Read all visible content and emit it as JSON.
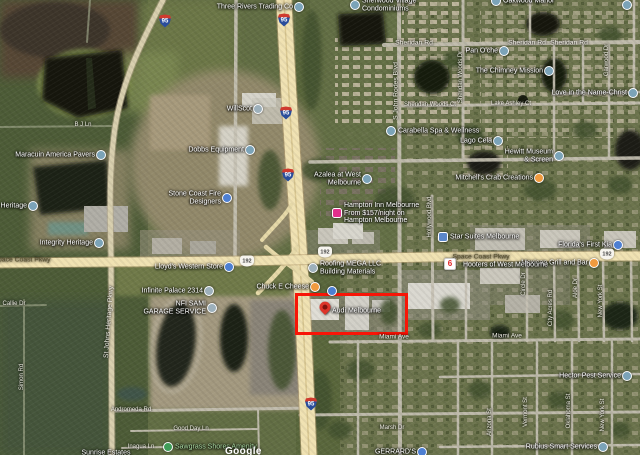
{
  "map": {
    "attribution": "Google",
    "colors": {
      "highlight_red": "#f81507",
      "major_road": "#f0e2b2",
      "water": "#161a0e",
      "marker_default": "#7ba3b8",
      "marker_store_blue": "#4d7fd2",
      "marker_restaurant_orange": "#f09a3e",
      "marker_hotel_pink": "#e2308c",
      "marker_park_green": "#3f9d58"
    },
    "highlight": {
      "label": "Audi Melbourne",
      "x": 295,
      "y": 293,
      "w": 107,
      "h": 36
    },
    "pois": [
      {
        "id": "three-rivers-trading-co",
        "lines": [
          "Three Rivers Trading Co"
        ],
        "x": 299,
        "y": 7,
        "side": "left",
        "shape": "circle",
        "color": "#7ba3b8"
      },
      {
        "id": "sherwood-village-condominiums",
        "lines": [
          "Sherwood Village",
          "Condominiums"
        ],
        "x": 355,
        "y": 5,
        "side": "right",
        "shape": "circle",
        "color": "#7ba3b8"
      },
      {
        "id": "oakwood-manor",
        "lines": [
          "Oakwood Manor"
        ],
        "x": 496,
        "y": 1,
        "side": "right",
        "shape": "circle",
        "color": "#7ba3b8"
      },
      {
        "id": "pan-oche",
        "lines": [
          "Pan O'che"
        ],
        "x": 504,
        "y": 51,
        "side": "left",
        "shape": "circle",
        "color": "#7ba3b8"
      },
      {
        "id": "the-chimney-mission",
        "lines": [
          "The Chimney Mission"
        ],
        "x": 549,
        "y": 71,
        "side": "left",
        "shape": "circle",
        "color": "#7ba3b8"
      },
      {
        "id": "love-in-the-name-christ",
        "lines": [
          "Love in the Name-Christ"
        ],
        "x": 633,
        "y": 93,
        "side": "left",
        "shape": "circle",
        "color": "#7ba3b8"
      },
      {
        "id": "carabella-spa-wellness",
        "lines": [
          "Carabella Spa & Wellness"
        ],
        "x": 391,
        "y": 131,
        "side": "right",
        "shape": "circle",
        "color": "#7ba3b8"
      },
      {
        "id": "willscot",
        "lines": [
          "WillScot"
        ],
        "x": 258,
        "y": 109,
        "side": "left",
        "shape": "circle",
        "color": "#9db0bb"
      },
      {
        "id": "dobbs-equipment",
        "lines": [
          "Dobbs Equipment"
        ],
        "x": 250,
        "y": 150,
        "side": "left",
        "shape": "circle",
        "color": "#7ba3b8"
      },
      {
        "id": "stone-coast-fire-designers",
        "lines": [
          "Stone Coast Fire",
          "Designers"
        ],
        "x": 227,
        "y": 198,
        "side": "left",
        "shape": "circle",
        "color": "#4d7fd2"
      },
      {
        "id": "maracuin-america-pavers",
        "lines": [
          "Maracuin America Pavers"
        ],
        "x": 101,
        "y": 155,
        "side": "left",
        "shape": "circle",
        "color": "#7ba3b8"
      },
      {
        "id": "a-heritage",
        "lines": [
          "…a Heritage"
        ],
        "x": 33,
        "y": 206,
        "side": "left",
        "shape": "circle",
        "color": "#7ba3b8"
      },
      {
        "id": "integrity-heritage",
        "lines": [
          "Integrity Heritage"
        ],
        "x": 99,
        "y": 243,
        "side": "left",
        "shape": "circle",
        "color": "#7ba3b8"
      },
      {
        "id": "infinite-palace-2314",
        "lines": [
          "Infinite Palace 2314"
        ],
        "x": 209,
        "y": 291,
        "side": "left",
        "shape": "circle",
        "color": "#9db0bb"
      },
      {
        "id": "nfi-sami-garage-service",
        "lines": [
          "NFI SAMI",
          "GARAGE SERVICE"
        ],
        "x": 212,
        "y": 308,
        "side": "left",
        "shape": "circle",
        "color": "#9db0bb"
      },
      {
        "id": "lloyds-western-store",
        "lines": [
          "Lloyd's Western Store"
        ],
        "x": 229,
        "y": 267,
        "side": "left",
        "shape": "circle",
        "color": "#4d7fd2"
      },
      {
        "id": "roofing-mega-llc",
        "lines": [
          "Roofing MEGA LLC",
          "Building Materials"
        ],
        "x": 313,
        "y": 268,
        "side": "right",
        "shape": "circle",
        "color": "#9db0bb"
      },
      {
        "id": "chuck-e-cheese",
        "lines": [
          "Chuck E Cheese"
        ],
        "x": 315,
        "y": 287,
        "side": "left",
        "shape": "circle",
        "color": "#f09a3e"
      },
      {
        "id": "unlabeled-marker-1",
        "lines": [],
        "x": 332,
        "y": 291,
        "side": "right",
        "shape": "circle",
        "color": "#4d7fd2"
      },
      {
        "id": "audi-melbourne",
        "lines": [
          "Audi Melbourne"
        ],
        "x": 325,
        "y": 311,
        "side": "right",
        "shape": "pin",
        "color": "#dd352a"
      },
      {
        "id": "mexican-grill-and-bar",
        "lines": [
          "Mexican Grill and Bar"
        ],
        "x": 594,
        "y": 263,
        "side": "left",
        "shape": "circle",
        "color": "#f09a3e"
      },
      {
        "id": "motel-6-logo",
        "lines": [],
        "x": 450,
        "y": 264,
        "side": "right",
        "shape": "logo6",
        "color": "#ffffff"
      },
      {
        "id": "hooters-of-west-melbourne",
        "lines": [
          "Hooters of West Melbourne"
        ],
        "x": 456,
        "y": 265,
        "side": "right",
        "shape": "none"
      },
      {
        "id": "floridas-first-kia",
        "lines": [
          "Florida's First Kia"
        ],
        "x": 618,
        "y": 245,
        "side": "left",
        "shape": "circle",
        "color": "#4d7fd2"
      },
      {
        "id": "star-suites-melbourne",
        "lines": [
          "Star Suites Melbourne"
        ],
        "x": 443,
        "y": 237,
        "side": "right",
        "shape": "square",
        "color": "#5b87c9"
      },
      {
        "id": "hampton-inn-melbourne",
        "lines": [
          "Hampton Inn Melbourne",
          "From $157/night on",
          "Hampton Melbourne"
        ],
        "x": 337,
        "y": 213,
        "side": "right",
        "shape": "square",
        "color": "#e2308c"
      },
      {
        "id": "azalea-at-west-melbourne",
        "lines": [
          "Azalea at West",
          "Melbourne"
        ],
        "x": 367,
        "y": 179,
        "side": "left",
        "shape": "circle",
        "color": "#7ba3b8"
      },
      {
        "id": "lago-cela",
        "lines": [
          "Lago Cela"
        ],
        "x": 498,
        "y": 141,
        "side": "left",
        "shape": "circle",
        "color": "#7ba3b8"
      },
      {
        "id": "hewitt-museum-screen",
        "lines": [
          "Hewitt Museum",
          "& Screen"
        ],
        "x": 559,
        "y": 156,
        "side": "left",
        "shape": "circle",
        "color": "#7ba3b8"
      },
      {
        "id": "mitchells-crab-creations",
        "lines": [
          "Mitchell's Crab Creations"
        ],
        "x": 539,
        "y": 178,
        "side": "left",
        "shape": "circle",
        "color": "#f09a3e"
      },
      {
        "id": "sawgrass-shores-amenity",
        "lines": [
          "Sawgrass Shores Amenity"
        ],
        "x": 168,
        "y": 447,
        "side": "right",
        "shape": "circle",
        "color": "#3f9d58",
        "lcolor": "#a9d9a2"
      },
      {
        "id": "hector-pest-service",
        "lines": [
          "Hector Pest Service"
        ],
        "x": 627,
        "y": 376,
        "side": "left",
        "shape": "circle",
        "color": "#7ba3b8"
      },
      {
        "id": "rubius-smart-services",
        "lines": [
          "Rubius Smart Services"
        ],
        "x": 603,
        "y": 447,
        "side": "left",
        "shape": "circle",
        "color": "#7ba3b8"
      },
      {
        "id": "gerrards",
        "lines": [
          "GERRARD'S"
        ],
        "x": 422,
        "y": 452,
        "side": "left",
        "shape": "circle",
        "color": "#4d7fd2"
      },
      {
        "id": "sunrise-estates",
        "lines": [
          "Sunrise Estates"
        ],
        "x": 106,
        "y": 453,
        "side": "center",
        "shape": "none"
      },
      {
        "id": "unlabeled-marker-2",
        "lines": [],
        "x": 627,
        "y": 5,
        "side": "right",
        "shape": "circle",
        "color": "#7ba3b8"
      }
    ],
    "road_labels": [
      {
        "text": "Sheridan Rd",
        "x": 414,
        "y": 43
      },
      {
        "text": "Sheridan Rd",
        "x": 527,
        "y": 43
      },
      {
        "text": "Sheridan Rd",
        "x": 569,
        "y": 43
      },
      {
        "text": "Sheridan Woods Ct",
        "x": 430,
        "y": 105,
        "size": 6
      },
      {
        "text": "Lake Ashley Ct",
        "x": 511,
        "y": 104,
        "size": 6
      },
      {
        "text": "Space Coast Pkwy",
        "x": 22,
        "y": 260,
        "color": "#57502f"
      },
      {
        "text": "Space Coast Pkwy",
        "x": 481,
        "y": 257,
        "color": "#57502f"
      },
      {
        "text": "Miami Ave",
        "x": 394,
        "y": 337,
        "size": 6.5
      },
      {
        "text": "Miami Ave",
        "x": 507,
        "y": 336,
        "size": 6.5
      },
      {
        "text": "Andromeda Rd",
        "x": 131,
        "y": 410,
        "size": 6
      },
      {
        "text": "Good Day Ln",
        "x": 191,
        "y": 429,
        "size": 6
      },
      {
        "text": "Inagua Ln",
        "x": 141,
        "y": 447,
        "size": 6
      },
      {
        "text": "Marsh Dr",
        "x": 392,
        "y": 428,
        "size": 6
      },
      {
        "text": "Callie Dr",
        "x": 14,
        "y": 304,
        "size": 6
      },
      {
        "text": "B J Ln",
        "x": 83,
        "y": 125,
        "size": 6
      },
      {
        "text": "S John Rodes Blvd",
        "x": 396,
        "y": 91,
        "rot": -90
      },
      {
        "text": "St Johns Heritage Pkwy",
        "x": 109,
        "y": 322,
        "rot": -86
      },
      {
        "text": "Hollywood Blvd",
        "x": 430,
        "y": 217,
        "rot": -90,
        "size": 6
      },
      {
        "text": "Sheridan Woods Dr",
        "x": 461,
        "y": 77,
        "rot": -90,
        "size": 6
      },
      {
        "text": "Garwood Dr",
        "x": 607,
        "y": 60,
        "rot": -90,
        "size": 6
      },
      {
        "text": "Simon Rd",
        "x": 22,
        "y": 377,
        "rot": -90,
        "size": 6
      },
      {
        "text": "Circle Dr",
        "x": 524,
        "y": 284,
        "rot": -90,
        "size": 6
      },
      {
        "text": "City Acres Rd",
        "x": 551,
        "y": 308,
        "rot": -90,
        "size": 6
      },
      {
        "text": "Aloe Dr",
        "x": 576,
        "y": 288,
        "rot": -90,
        "size": 6
      },
      {
        "text": "New York St",
        "x": 601,
        "y": 301,
        "rot": -90,
        "size": 6
      },
      {
        "text": "Arizona St",
        "x": 490,
        "y": 422,
        "rot": -90,
        "size": 6
      },
      {
        "text": "Vermont St",
        "x": 526,
        "y": 412,
        "rot": -90,
        "size": 6
      },
      {
        "text": "Oklahoma St",
        "x": 569,
        "y": 411,
        "rot": -90,
        "size": 6
      },
      {
        "text": "New York St",
        "x": 603,
        "y": 415,
        "rot": -90,
        "size": 6
      }
    ],
    "shields": [
      {
        "type": "i95",
        "text": "95",
        "x": 165,
        "y": 21
      },
      {
        "type": "i95",
        "text": "95",
        "x": 284,
        "y": 20
      },
      {
        "type": "i95",
        "text": "95",
        "x": 286,
        "y": 113
      },
      {
        "type": "i95",
        "text": "95",
        "x": 288,
        "y": 175
      },
      {
        "type": "i95",
        "text": "95",
        "x": 311,
        "y": 404
      },
      {
        "type": "sr",
        "text": "192",
        "x": 247,
        "y": 261
      },
      {
        "type": "sr",
        "text": "192",
        "x": 325,
        "y": 252
      },
      {
        "type": "sr",
        "text": "192",
        "x": 607,
        "y": 254
      }
    ]
  }
}
